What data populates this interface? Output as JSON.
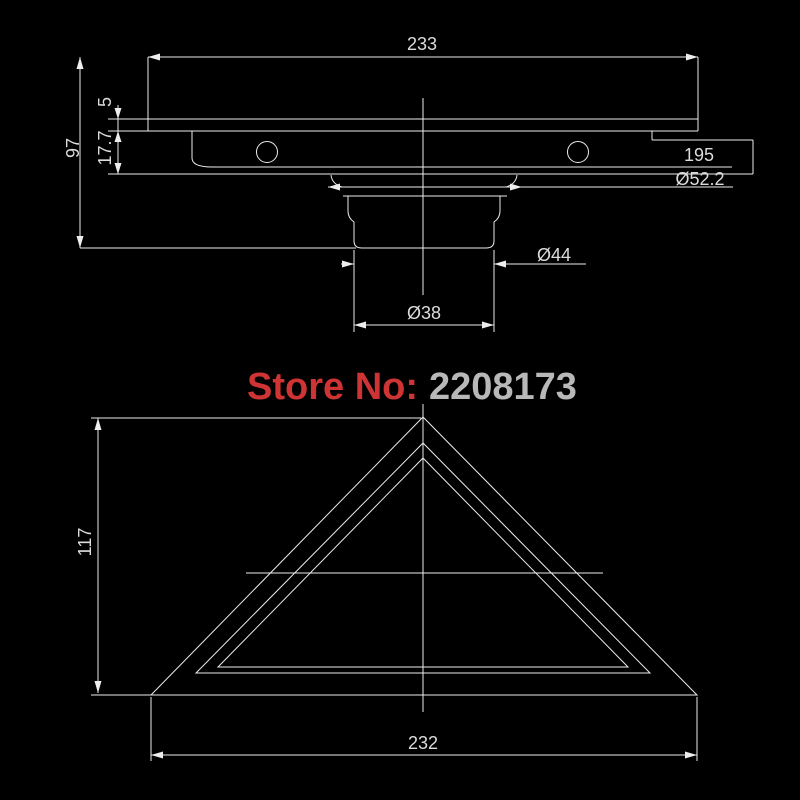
{
  "colors": {
    "background": "#000000",
    "line": "#ededed",
    "dimension_text": "#dcdcdc",
    "watermark_label": "#cf3434",
    "watermark_number": "#b8b8b8"
  },
  "watermark": {
    "label": "Store No:",
    "number": "2208173"
  },
  "top_view": {
    "overall_width": "233",
    "overall_height": "97",
    "cover_thickness": "5",
    "body_depth": "17.7",
    "length_label": "195",
    "dia_flange": "Ø52.2",
    "dia_outlet_outer": "Ø44",
    "dia_outlet_inner": "Ø38"
  },
  "bottom_view": {
    "height": "117",
    "width": "232"
  }
}
